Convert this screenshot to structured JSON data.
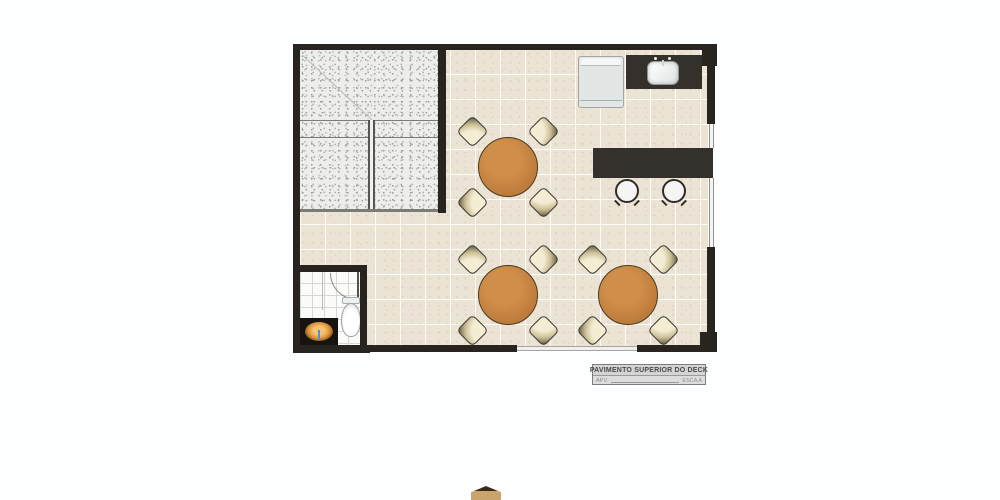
{
  "title_block": {
    "title": "PAVIMENTO SUPERIOR DO DECK",
    "left_label": "APV.",
    "right_label": "ESCA A"
  },
  "plan": {
    "description": "Top-down architectural floor plan of an upper deck level",
    "rooms": [
      {
        "name": "dining-area",
        "items": [
          "round-table-with-4-chairs",
          "round-table-with-4-chairs",
          "round-table-with-4-chairs",
          "bar-counter",
          "bar-stool",
          "bar-stool",
          "refrigerator",
          "sink-counter"
        ]
      },
      {
        "name": "bathroom",
        "items": [
          "toilet",
          "vessel-sink-vanity",
          "door-swing"
        ]
      },
      {
        "name": "stair-void",
        "items": [
          "railing",
          "granite-texture"
        ]
      }
    ]
  },
  "colors": {
    "wall": "#282521",
    "floor_tile": "#ebe3d4",
    "granite": "#edeeec",
    "table_wood": "#bd7c3a",
    "chair_cream": "#f4edd4",
    "counter_dark": "#34302c",
    "vanity_bowl_accent": "#d98f36",
    "page_background": "#fdfeff"
  }
}
